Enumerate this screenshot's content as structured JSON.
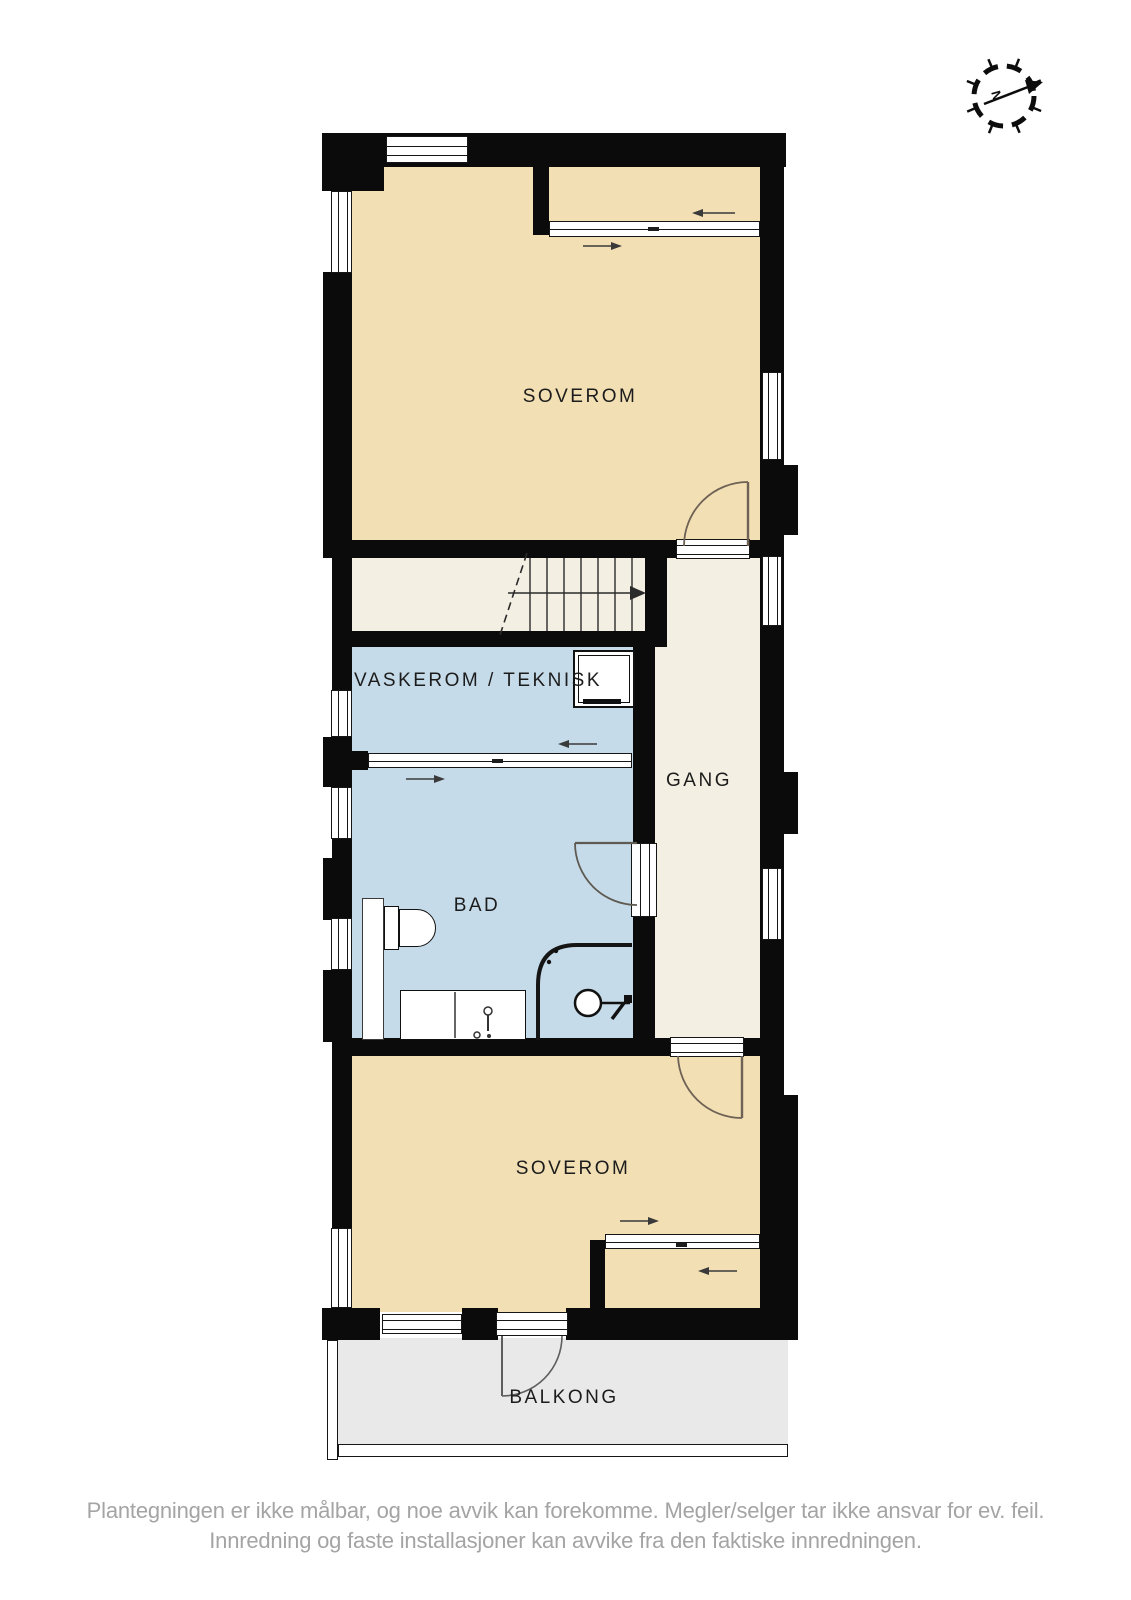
{
  "plan_title": "floor-plan",
  "rooms": {
    "soverom_top": {
      "label": "SOVEROM"
    },
    "vaskerom": {
      "label": "VASKEROM / TEKNISK"
    },
    "gang": {
      "label": "GANG"
    },
    "bad": {
      "label": "BAD"
    },
    "soverom_bottom": {
      "label": "SOVEROM"
    },
    "balkong": {
      "label": "BALKONG"
    }
  },
  "compass": {
    "north_label": "N"
  },
  "disclaimer": {
    "line1": "Plantegningen er ikke målbar, og noe avvik kan forekomme. Megler/selger tar ikke ansvar for ev. feil.",
    "line2": "Innredning og faste installasjoner kan avvike fra den faktiske innredningen."
  },
  "colors": {
    "bedroom_fill": "#f2dfb4",
    "wet_room_fill": "#c6dbe9",
    "hall_fill": "#f3efe2",
    "balcony_fill": "#e9e9e9",
    "wall": "#0b0b0b",
    "door_swing": "#6e6155",
    "label_text": "#1c1c1c",
    "disclaimer_text": "#a4a4a4"
  }
}
